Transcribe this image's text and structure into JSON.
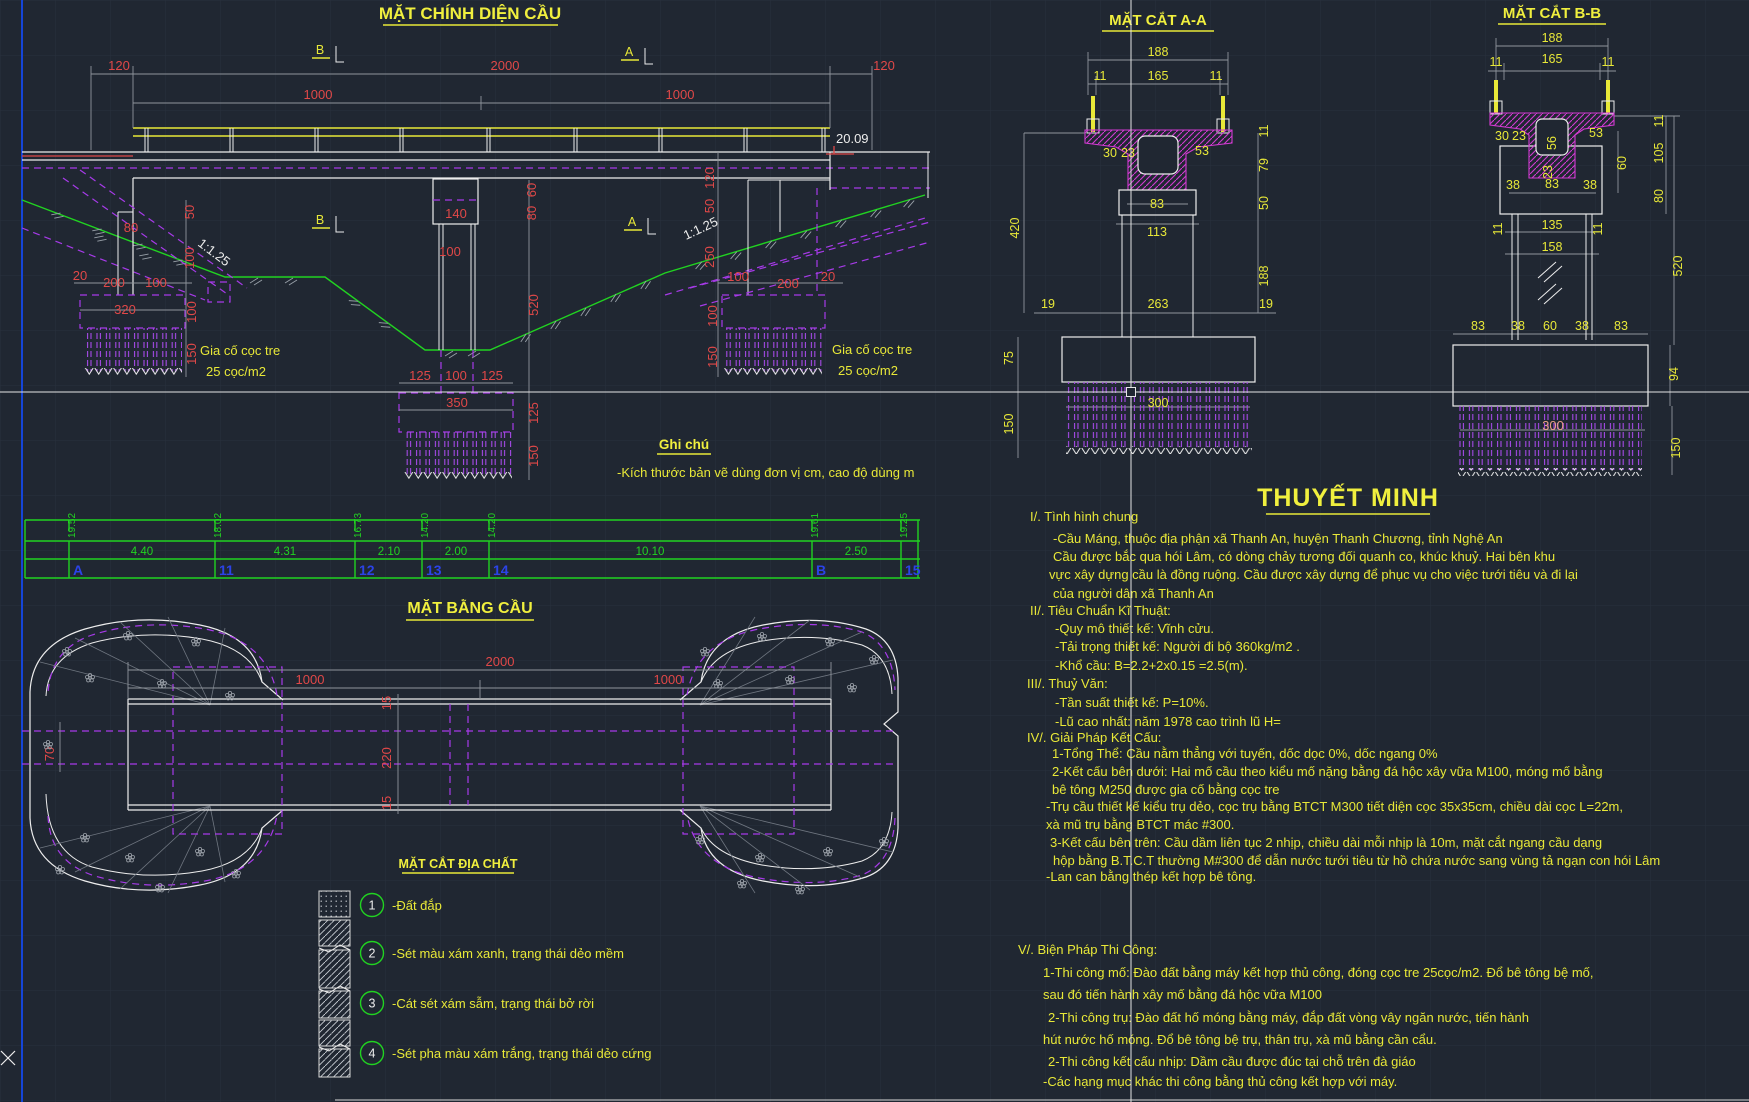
{
  "colors": {
    "background": "#202732",
    "grid": "#29303d",
    "dim_red": "#e04848",
    "dim_yellow": "#e8e838",
    "text_white": "#ededed",
    "green": "#21d321",
    "magenta_hatch": "#d23ad2",
    "purple_hidden": "#a63ae8",
    "station_blue": "#2b43e8",
    "frame_blue": "#1545d8",
    "salmon": "#e89f86"
  },
  "front_elevation": {
    "title": "MẶT CHÍNH DIỆN CẦU",
    "marker_a": "A",
    "marker_b": "B",
    "spot_elevation": "20.09",
    "slope_label": "1:1.25",
    "pile_note_line1": "Gia cố cọc tre",
    "pile_note_line2": "25 cọc/m2",
    "dims": [
      "120",
      "2000",
      "1000",
      "1000",
      "120",
      "80",
      "50",
      "100",
      "20",
      "200",
      "100",
      "320",
      "100",
      "150",
      "140",
      "100",
      "60",
      "80",
      "520",
      "125",
      "100",
      "125",
      "350",
      "125",
      "150",
      "120",
      "50",
      "250",
      "100",
      "200",
      "20",
      "100",
      "150"
    ]
  },
  "general_note": {
    "title": "Ghi chú",
    "line": "-Kích thước bản vẽ dùng đơn vị cm, cao độ dùng m"
  },
  "section_aa": {
    "title": "MẶT CẮT A-A",
    "dims": [
      "188",
      "11",
      "165",
      "11",
      "30",
      "23",
      "53",
      "83",
      "113",
      "11",
      "79",
      "50",
      "188",
      "420",
      "19",
      "263",
      "19",
      "75",
      "150",
      "300"
    ]
  },
  "section_bb": {
    "title": "MẶT CẮT B-B",
    "dims": [
      "188",
      "11",
      "165",
      "11",
      "30",
      "23",
      "53",
      "56",
      "23",
      "38",
      "83",
      "38",
      "60",
      "11",
      "105",
      "80",
      "11",
      "135",
      "11",
      "158",
      "520",
      "83",
      "38",
      "60",
      "38",
      "83",
      "94",
      "300",
      "150"
    ]
  },
  "profile_table": {
    "elevations": [
      "19.52",
      "18.02",
      "16.73",
      "14.20",
      "14.20",
      "19.61",
      "19.25"
    ],
    "distances": [
      "4.40",
      "4.31",
      "2.10",
      "2.00",
      "10.10",
      "2.50"
    ],
    "stations": [
      "A",
      "11",
      "12",
      "13",
      "14",
      "B",
      "15"
    ]
  },
  "plan_view": {
    "title": "MẶT BẰNG CẦU",
    "dims": [
      "2000",
      "1000",
      "1000",
      "15",
      "220",
      "15",
      "70"
    ]
  },
  "geology_legend": {
    "title": "MẶT CẮT ĐỊA CHẤT",
    "items": [
      {
        "no": "1",
        "label": "-Đất đắp"
      },
      {
        "no": "2",
        "label": "-Sét màu xám xanh, trạng thái dẻo mềm"
      },
      {
        "no": "3",
        "label": "-Cát sét xám sẫm, trạng thái bở rời"
      },
      {
        "no": "4",
        "label": "-Sét pha màu xám trắng, trạng thái dẻo cứng"
      }
    ]
  },
  "notes": {
    "title": "THUYẾT MINH",
    "lines": [
      "I/. Tình hình chung",
      "-Cầu Máng, thuộc địa phận xã Thanh An, huyện Thanh Chương, tỉnh Nghệ An",
      "Cầu được bắc qua hói Lâm, có dòng chảy tương đối quanh co, khúc khuỷ. Hai bên khu",
      "vực xây dựng cầu là đồng ruộng. Cầu được xây dựng để phục vụ cho việc tưới tiêu và đi lại",
      "của người dân xã Thanh An",
      "II/. Tiêu Chuẩn Kĩ Thuật:",
      "-Quy mô thiết kế: Vĩnh cửu.",
      "-Tải trọng thiết kế: Người đi bộ 360kg/m2 .",
      "-Khổ cầu: B=2.2+2x0.15 =2.5(m).",
      "III/. Thuỷ Văn:",
      "-Tần suất thiết kế: P=10%.",
      "-Lũ cao nhất: năm 1978 cao trình lũ H=",
      "IV/. Giải Pháp Kết Cấu:",
      "1-Tổng Thể: Cầu nằm thẳng với tuyến, dốc dọc 0%, dốc ngang 0%",
      "2-Kết cấu bên dưới: Hai mố cầu theo kiểu mố nặng bằng đá hộc xây vữa M100, móng mố bằng",
      "bê tông M250 được gia cố bằng cọc tre",
      "-Trụ cầu thiết kế kiểu trụ dẻo, cọc trụ bằng BTCT M300 tiết diện cọc 35x35cm, chiều dài cọc L=22m,",
      "xà mũ trụ bằng BTCT mác #300.",
      "3-Kết cấu bên trên: Cầu dầm liên tục 2 nhịp, chiều dài mỗi nhịp là 10m, mặt cắt ngang cầu dạng",
      "hộp bằng B.T.C.T thường M#300 để dẫn nước tưới tiêu từ hồ chứa nước sang vùng tả ngạn con hói Lâm",
      "-Lan can bằng thép kết hợp bê tông.",
      "V/. Biện Pháp Thi Công:",
      "1-Thi công mố: Đào đất bằng máy kết hợp thủ công, đóng cọc tre 25cọc/m2. Đổ bê tông bệ mố,",
      "sau đó tiến hành xây mố bằng đá hộc vữa M100",
      "2-Thi công trụ: Đào đất hố móng bằng máy, đắp đất vòng vây ngăn nước, tiến hành",
      "hút nước hố móng. Đổ bê tông bệ trụ, thân trụ, xà mũ bằng cần cẩu.",
      "2-Thi công kết cấu nhịp: Dầm cầu được đúc tại chỗ trên đà giáo",
      "-Các hạng mục khác thi công bằng thủ công kết hợp với máy."
    ]
  }
}
